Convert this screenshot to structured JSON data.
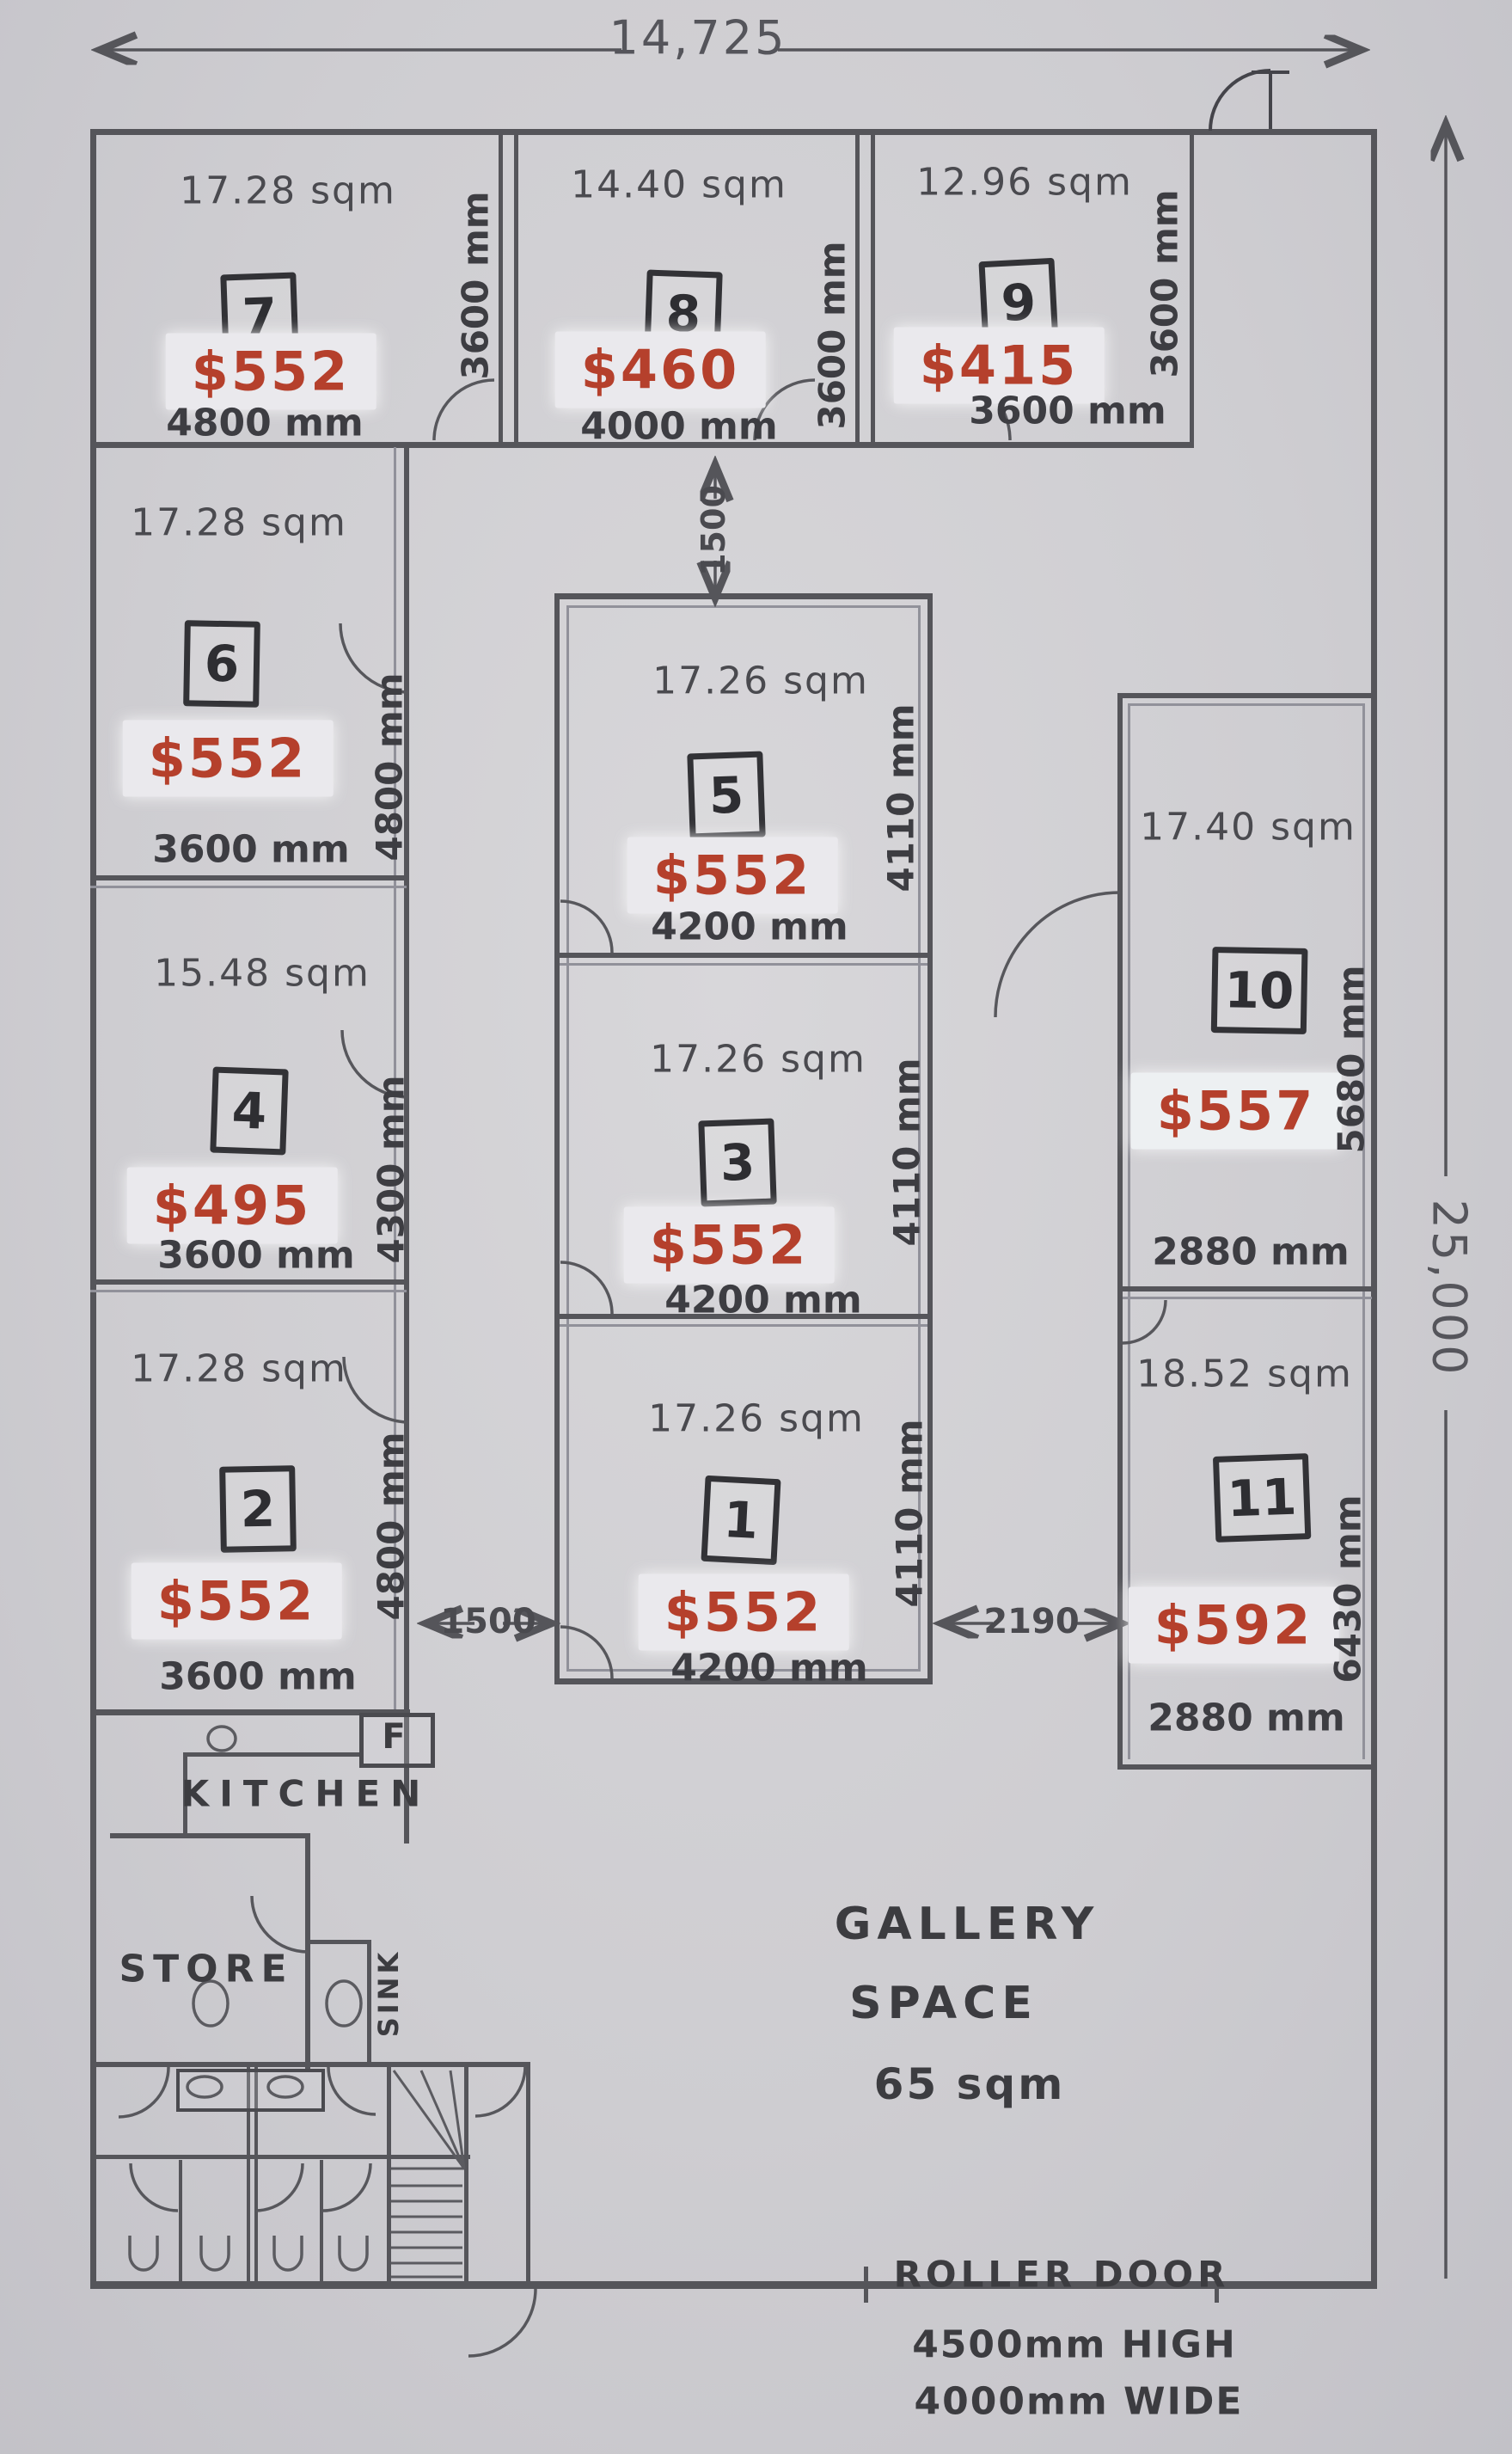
{
  "overall": {
    "width_mm": "14,725",
    "height_mm": "25,000"
  },
  "corridors": {
    "top": "1500",
    "left": "1500",
    "right": "2190"
  },
  "rooms": [
    {
      "number": "1",
      "area": "17.26 sqm",
      "price": "$552",
      "width": "4200 mm",
      "depth": "4110 mm"
    },
    {
      "number": "2",
      "area": "17.28 sqm",
      "price": "$552",
      "width": "3600 mm",
      "depth": "4800 mm"
    },
    {
      "number": "3",
      "area": "17.26 sqm",
      "price": "$552",
      "width": "4200 mm",
      "depth": "4110 mm"
    },
    {
      "number": "4",
      "area": "15.48 sqm",
      "price": "$495",
      "width": "3600 mm",
      "depth": "4300 mm"
    },
    {
      "number": "5",
      "area": "17.26 sqm",
      "price": "$552",
      "width": "4200 mm",
      "depth": "4110 mm"
    },
    {
      "number": "6",
      "area": "17.28 sqm",
      "price": "$552",
      "width": "3600 mm",
      "depth": "4800 mm"
    },
    {
      "number": "7",
      "area": "17.28 sqm",
      "price": "$552",
      "width": "4800 mm",
      "depth": "3600 mm"
    },
    {
      "number": "8",
      "area": "14.40 sqm",
      "price": "$460",
      "width": "4000 mm",
      "depth": "3600 mm"
    },
    {
      "number": "9",
      "area": "12.96 sqm",
      "price": "$415",
      "width": "3600 mm",
      "depth": "3600 mm"
    },
    {
      "number": "10",
      "area": "17.40 sqm",
      "price": "$557",
      "width": "2880 mm",
      "depth": "5680 mm"
    },
    {
      "number": "11",
      "area": "18.52 sqm",
      "price": "$592",
      "width": "2880 mm",
      "depth": "6430 mm"
    }
  ],
  "areas": {
    "kitchen": "KITCHEN",
    "store": "STORE",
    "sink": "SINK",
    "fridge": "F",
    "gallery": [
      "GALLERY",
      "SPACE",
      "65 sqm"
    ]
  },
  "roller_door": {
    "label": "ROLLER DOOR",
    "height": "4500mm HIGH",
    "width": "4000mm WIDE"
  },
  "colors": {
    "paper": "#cecdd1",
    "ink": "#3d3d42",
    "pencil": "#55555a",
    "price_red": "#b5402c",
    "sticker": "#eae9ed"
  }
}
